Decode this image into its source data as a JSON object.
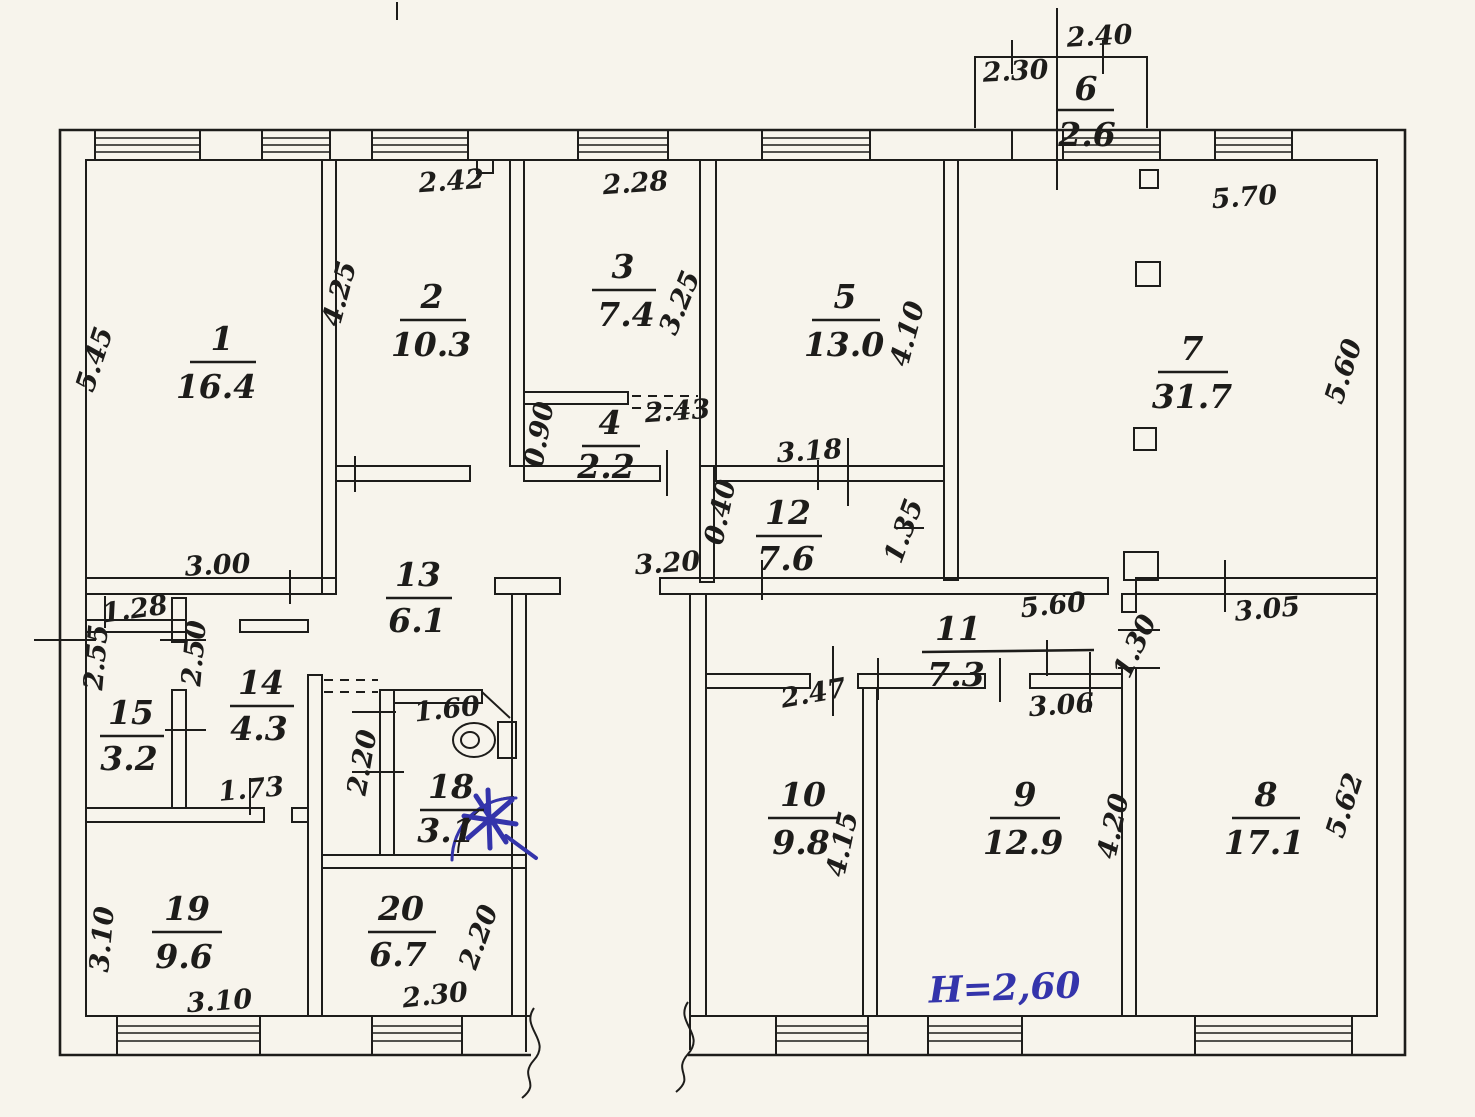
{
  "note": {
    "height": "H=2,60"
  },
  "rooms": {
    "r1": {
      "n": "1",
      "a": "16.4"
    },
    "r2": {
      "n": "2",
      "a": "10.3"
    },
    "r3": {
      "n": "3",
      "a": "7.4"
    },
    "r4": {
      "n": "4",
      "a": "2.2"
    },
    "r5": {
      "n": "5",
      "a": "13.0"
    },
    "r6": {
      "n": "6",
      "a": "2.6"
    },
    "r7": {
      "n": "7",
      "a": "31.7"
    },
    "r8": {
      "n": "8",
      "a": "17.1"
    },
    "r9": {
      "n": "9",
      "a": "12.9"
    },
    "r10": {
      "n": "10",
      "a": "9.8"
    },
    "r11": {
      "n": "11",
      "a": "7.3"
    },
    "r12": {
      "n": "12",
      "a": "7.6"
    },
    "r13": {
      "n": "13",
      "a": "6.1"
    },
    "r14": {
      "n": "14",
      "a": "4.3"
    },
    "r15": {
      "n": "15",
      "a": "3.2"
    },
    "r18": {
      "n": "18",
      "a": "3.1"
    },
    "r19": {
      "n": "19",
      "a": "9.6"
    },
    "r20": {
      "n": "20",
      "a": "6.7"
    }
  },
  "dims": {
    "balcony_top": "2.40",
    "balcony_left": "2.30",
    "r7_top": "5.70",
    "r7_right": "5.60",
    "r2_top": "2.42",
    "r3_top": "2.28",
    "r2_left": "4.25",
    "r1_left": "5.45",
    "r3_right": "3.25",
    "r5_right": "4.10",
    "r4_left": "0.90",
    "r4_top": "2.43",
    "r12_top": "3.18",
    "r12_left": "0.40",
    "r12_right": "1.35",
    "r1_bottom": "3.00",
    "corridor13": "3.20",
    "r15_top": "1.28",
    "r15_left": "2.55",
    "r14_left": "2.50",
    "r14_bottom": "1.73",
    "r18_top": "1.60",
    "r18_left": "2.20",
    "r19_left": "3.10",
    "r19_bottom": "3.10",
    "r20_bottom": "2.30",
    "r20_right": "2.20",
    "r11_top": "5.60",
    "r11_right": "1.30",
    "r10_top": "2.47",
    "r10_right": "4.15",
    "r9_top": "3.06",
    "r9_right": "4.20",
    "r8_top": "3.05",
    "r8_right": "5.62"
  }
}
